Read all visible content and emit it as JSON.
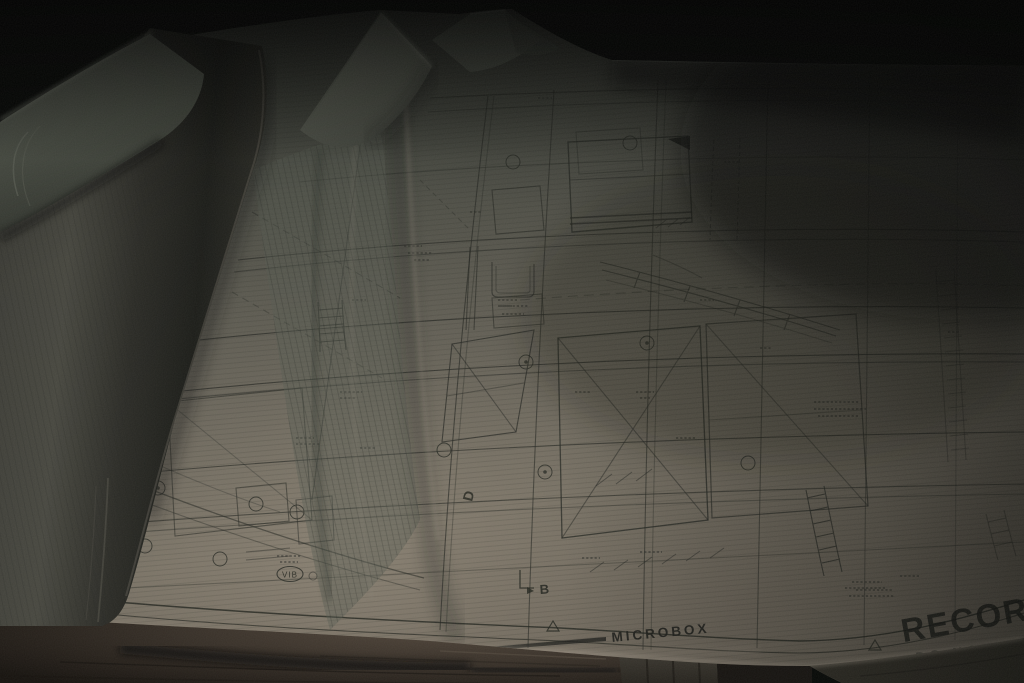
{
  "scene": {
    "description": "Dimly lit photograph of architectural blueprint sheets unrolled across a table; spare rolled sheets lie along the left edge and the bottom edge of the top sheet curls upward toward the camera.",
    "sheet_content": "Dense architectural floor plan: wall lines, dimension strings, circled grid markers, stair and ramp details, and hand-lettered notes"
  },
  "blueprint": {
    "border_label": "MICROBOX",
    "stamp_text": "RECORDED",
    "warning_text": "DO NOT SCALE",
    "detail_bubble_label": "VIB",
    "section_marker_b": "B",
    "section_marker_d": "D"
  },
  "palette": {
    "background": "#060806",
    "paper_highlight": "#978c7e",
    "paper_midtone": "#5a594f",
    "paper_shadow": "#343731",
    "ink": "#23251f",
    "table_wood": "#2b2620"
  }
}
